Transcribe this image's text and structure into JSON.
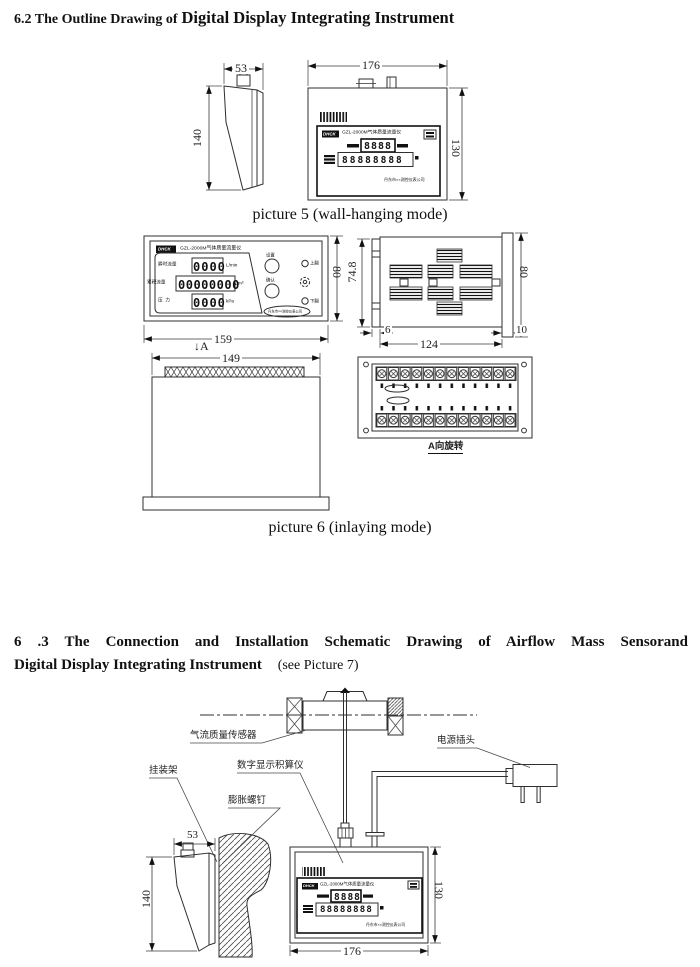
{
  "section_6_2": {
    "title_prefix": "6.2 The Outline Drawing of",
    "title_main": "Digital Display Integrating Instrument"
  },
  "picture5": {
    "caption": "picture 5 (wall-hanging mode)",
    "dims": {
      "side_width": "53",
      "side_height": "140",
      "front_width": "176",
      "front_height": "130"
    }
  },
  "instrument_display": {
    "brand": "DHCK",
    "model_title": "GZL-2000M气体质量流量仪",
    "flow_digits": "8888",
    "total_digits": "88888888",
    "company": "丹东市××测控仪表公司"
  },
  "picture6": {
    "caption": "picture 6 (inlaying mode)",
    "panel": {
      "brand": "DHCK",
      "title": "GZL-2000M气体质量流量仪",
      "rows": [
        {
          "label": "瞬时流量",
          "value": "0000",
          "unit": "L/min"
        },
        {
          "label": "累积流量",
          "value": "00000000",
          "unit": "m³"
        },
        {
          "label": "压  力",
          "value": "0000",
          "unit": "kPa"
        }
      ],
      "buttons": {
        "set": "设置",
        "confirm": "确认",
        "up": "上翻",
        "down": "下翻"
      },
      "company": "丹东市××测控仪表公司"
    },
    "dims": {
      "panel_width": "159",
      "panel_height": "80",
      "side_depth": "74.8",
      "side_height": "80",
      "bezel_depth": "6",
      "body_depth": "124",
      "flange_depth": "10",
      "cutout_width": "149"
    },
    "view_arrow": "↓A",
    "terminal_caption": "A向旋转"
  },
  "section_6_3": {
    "title_line1": "6 .3 The Connection and Installation Schematic Drawing of Airflow Mass Sensorand",
    "title_line2": "Digital Display Integrating Instrument",
    "title_suffix": "(see Picture 7)"
  },
  "picture7": {
    "labels": {
      "sensor": "气流质量传感器",
      "power_plug": "电源插头",
      "bracket": "挂装架",
      "instrument": "数字显示积算仪",
      "screw": "膨胀螺钉"
    },
    "dims": {
      "side_width": "53",
      "side_height": "140",
      "front_width": "176",
      "front_height": "130"
    }
  }
}
